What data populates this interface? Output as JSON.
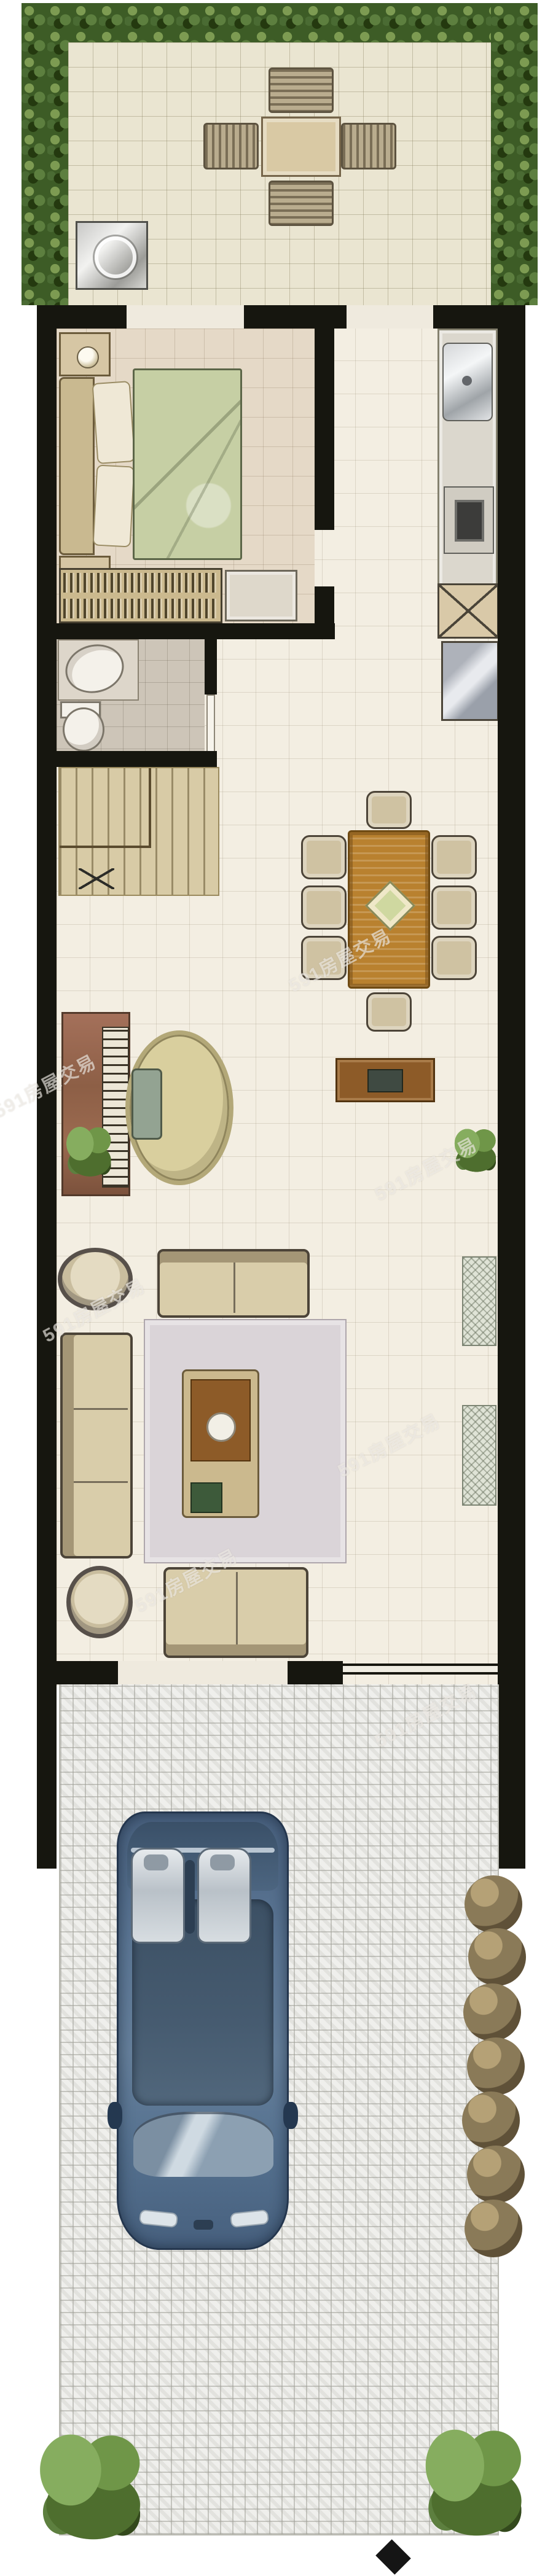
{
  "watermark": {
    "text": "591房屋交易"
  },
  "palette": {
    "hedge_green_dark": "#3d5c26",
    "hedge_green_light": "#7d9b52",
    "wall_black": "#16160f",
    "patio_tile": "#eae5d1",
    "interior_floor": "#f3eee2",
    "bedroom_floor": "#e5d9c7",
    "bathroom_floor": "#cdc5b8",
    "stairs_floor": "#d8cba6",
    "duvet_green": "#c6cfa4",
    "dining_table_wood": "#b9812f",
    "sofa_beige": "#d9cdaa",
    "living_rug": "#dad4d8",
    "car_blue": "#54708e",
    "paving_grey": "#efefec",
    "shrub_brown": "#8a7a58",
    "bush_green": "#5d7f3f"
  },
  "plan": {
    "type": "residential floor plan, top-down illustrated",
    "garden": {
      "items": [
        "hedge border (top, left, right)",
        "tiled patio",
        "square outdoor table",
        "4 slatted chairs",
        "grill/sink unit"
      ]
    },
    "bedroom": {
      "items": [
        "double bed with green duvet",
        "headboard",
        "2 pillows",
        "2 nightstands with lamps",
        "wardrobe with hanging clothes",
        "dresser"
      ]
    },
    "kitchen": {
      "items": [
        "counter strip on right wall",
        "stainless sink with faucet",
        "cooktop",
        "crossed storage unit",
        "refrigerator"
      ]
    },
    "bathroom": {
      "items": [
        "vanity with oval sink",
        "toilet",
        "door leaf"
      ]
    },
    "stairs": {
      "items": [
        "straight stair treads",
        "banister",
        "cross marker"
      ]
    },
    "dining": {
      "items": [
        "rectangular wood table",
        "8 chairs",
        "diamond centerpiece",
        "sideboard with decor",
        "potted plant"
      ]
    },
    "study_corner": {
      "items": [
        "upright piano",
        "keyboard",
        "round rug",
        "bench",
        "potted plant"
      ]
    },
    "living": {
      "items": [
        "two-seat sofa (top)",
        "three-seat sofa (left)",
        "two-seat sofa (bottom)",
        "2 round armchairs",
        "area rug",
        "coffee table with tray, plate and planter box",
        "2 lattice windows on right wall"
      ]
    },
    "exterior": {
      "items": [
        "front entrance opening",
        "herringbone paved porch and driveway",
        "blue sedan seen from above",
        "brown shrub row on right",
        "2 green bushes at driveway end",
        "black diamond marker"
      ]
    }
  }
}
